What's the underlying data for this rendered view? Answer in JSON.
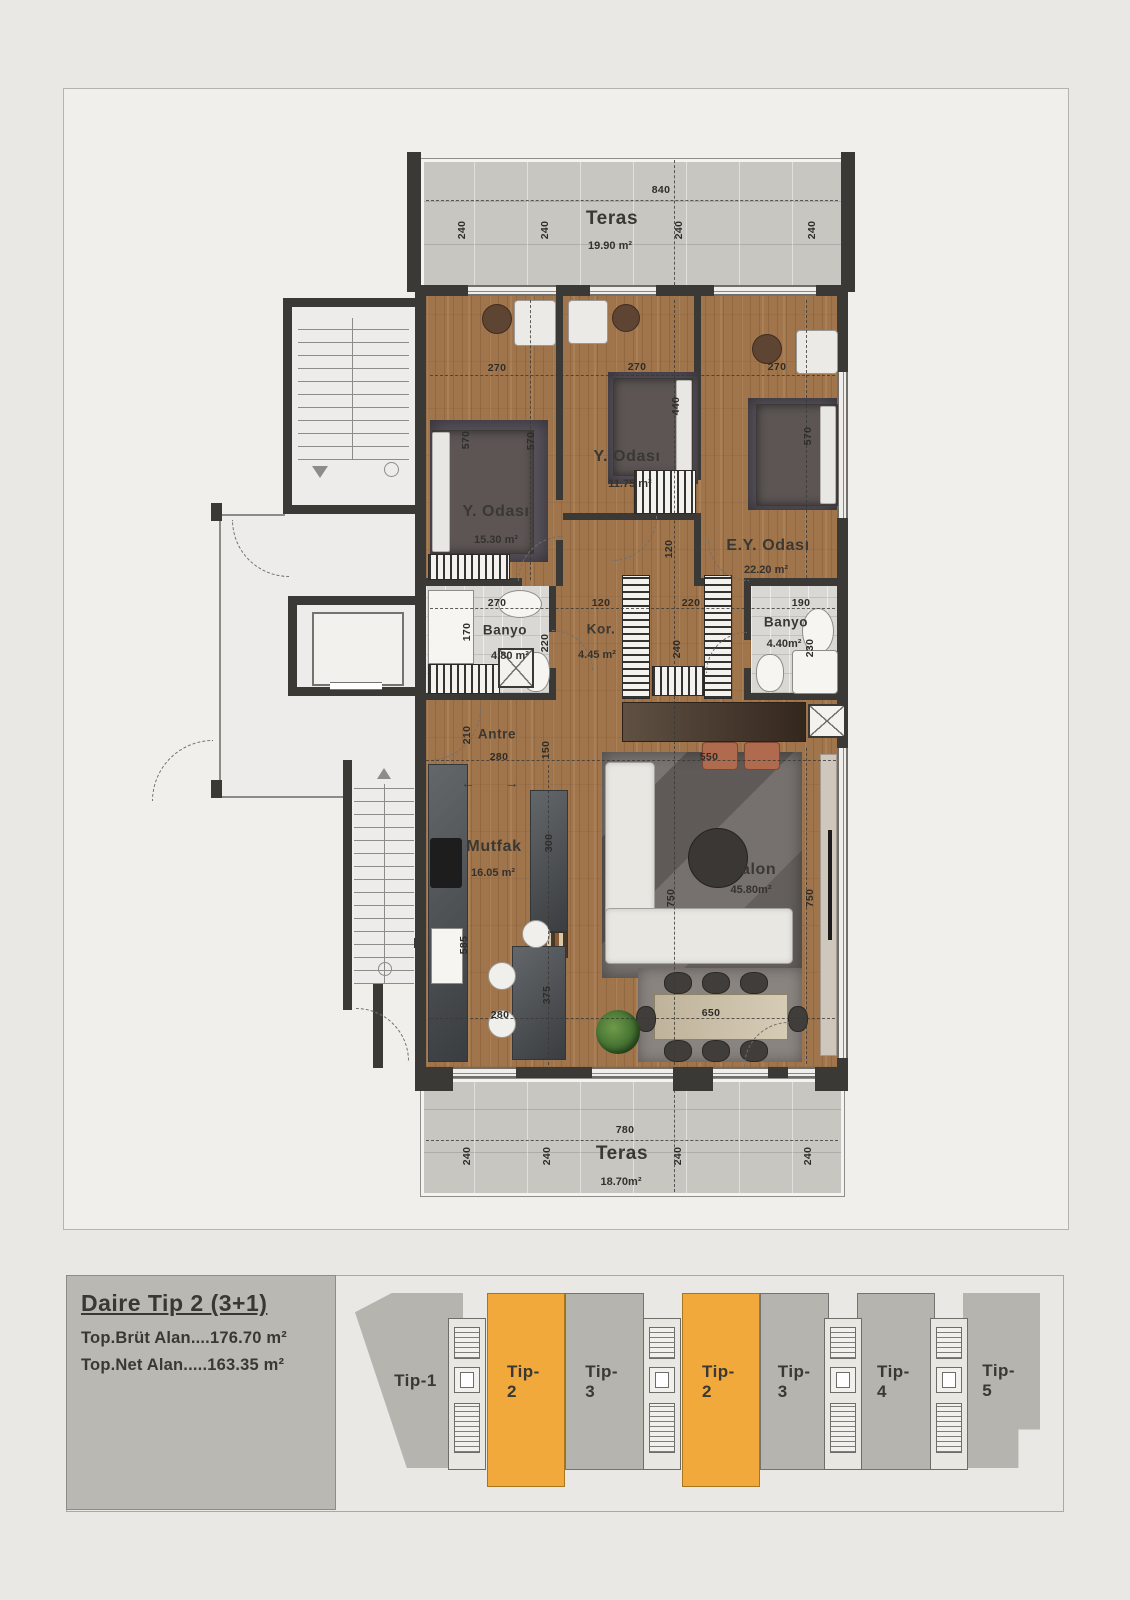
{
  "legend": {
    "title": "Daire Tip 2 (3+1)",
    "gross": "Top.Brüt Alan....176.70 m²",
    "net": "Top.Net Alan.....163.35 m²"
  },
  "rooms": {
    "teras_top": {
      "name": "Teras",
      "area": "19.90 m²"
    },
    "bedroom_left": {
      "name": "Y. Odası",
      "area": "15.30 m²"
    },
    "bedroom_mid": {
      "name": "Y. Odası",
      "area": "11.75 m²"
    },
    "bedroom_master": {
      "name": "E.Y. Odası",
      "area": "22.20 m²"
    },
    "banyo_left": {
      "name": "Banyo",
      "area": "4.80 m²"
    },
    "koridor": {
      "name": "Kor.",
      "area": "4.45 m²"
    },
    "banyo_right": {
      "name": "Banyo",
      "area": "4.40m²"
    },
    "antre": {
      "name": "Antre"
    },
    "mutfak": {
      "name": "Mutfak",
      "area": "16.05 m²"
    },
    "salon": {
      "name": "Salon",
      "area": "45.80m²"
    },
    "teras_bottom": {
      "name": "Teras",
      "area": "18.70m²"
    }
  },
  "dims": {
    "840": "840",
    "780": "780",
    "240": "240",
    "270": "270",
    "570": "570",
    "440": "440",
    "120": "120",
    "170": "170",
    "220": "220",
    "230": "230",
    "190": "190",
    "210": "210",
    "280": "280",
    "150": "150",
    "550": "550",
    "650": "650",
    "300": "300",
    "585": "585",
    "375": "375",
    "750": "750"
  },
  "units": [
    {
      "label": "Tip-1",
      "highlight": false
    },
    {
      "label": "Tip-2",
      "highlight": true
    },
    {
      "label": "Tip-3",
      "highlight": false
    },
    {
      "label": "Tip-2",
      "highlight": true
    },
    {
      "label": "Tip-3",
      "highlight": false
    },
    {
      "label": "Tip-4",
      "highlight": false
    },
    {
      "label": "Tip-5",
      "highlight": false
    }
  ],
  "icons": {
    "slide_left": "←",
    "slide_right": "→"
  },
  "colors": {
    "highlight": "#f2a93b",
    "unit_gray": "#b6b4ae",
    "wall": "#3b3936",
    "wood": "#a1754c",
    "terrace": "#c8c6c1",
    "page": "#e9e8e5"
  }
}
